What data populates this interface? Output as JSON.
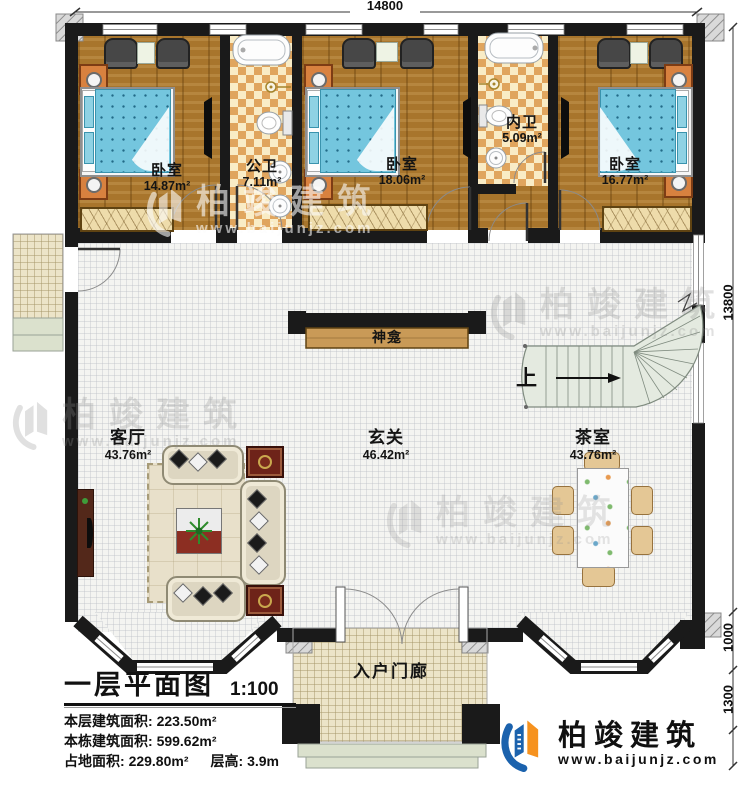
{
  "dimensions": {
    "top": "14800",
    "side": "13800",
    "porch_depth": "1000",
    "steps_depth": "1300"
  },
  "rooms": {
    "bedroom_left": {
      "name": "卧室",
      "area": "14.87m²"
    },
    "bath_public": {
      "name": "公卫",
      "area": "7.11m²"
    },
    "bedroom_mid": {
      "name": "卧室",
      "area": "18.06m²"
    },
    "bath_inner": {
      "name": "内卫",
      "area": "5.09m²"
    },
    "bedroom_right": {
      "name": "卧室",
      "area": "16.77m²"
    },
    "living": {
      "name": "客厅",
      "area": "43.76m²"
    },
    "foyer": {
      "name": "玄关",
      "area": "46.42m²"
    },
    "tea": {
      "name": "茶室",
      "area": "43.76m²"
    },
    "porch": {
      "name": "入户门廊"
    }
  },
  "annotations": {
    "shrine": "神龛",
    "stairs_up": "上"
  },
  "title_block": {
    "title": "一层平面图",
    "scale": "1:100",
    "rows": [
      {
        "label": "本层建筑面积:",
        "value": "223.50m²"
      },
      {
        "label": "本栋建筑面积:",
        "value": "599.62m²"
      },
      {
        "label": "占地面积:",
        "value": "229.80m²"
      },
      {
        "label": "层高:",
        "value": "3.9m"
      }
    ]
  },
  "watermark": {
    "brand": "柏竣建筑",
    "url": "www.baijunjz.com"
  },
  "logo": {
    "brand": "柏竣建筑",
    "url": "www.baijunjz.com"
  },
  "colors": {
    "wall": "#1a1a1a",
    "wood": "#a8752c",
    "brand_blue": "#1b62ad",
    "brand_orange": "#f6921e",
    "stair": "#e4eae0"
  }
}
